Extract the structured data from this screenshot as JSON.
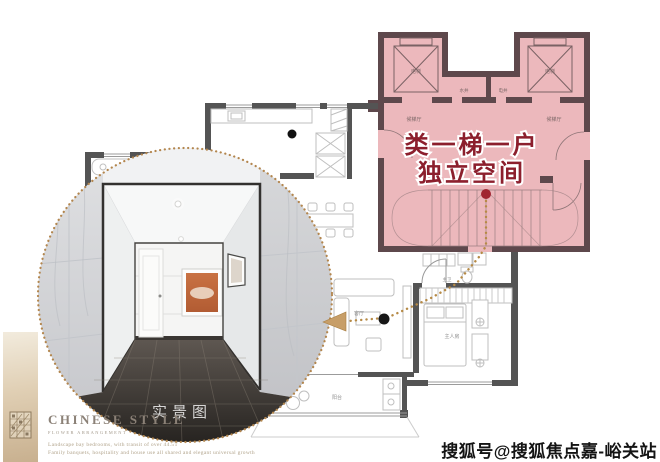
{
  "core": {
    "overlay_line1": "类一梯一户",
    "overlay_line2": "独立空间",
    "elevator_label": "电梯",
    "shaft_water_label": "水井",
    "shaft_elec_label": "电井",
    "lobby_label": "候梯厅"
  },
  "rooms": {
    "living_label": "客厅",
    "bedroom_label": "主人房",
    "bath_label": "主卫",
    "balcony_label": "阳台"
  },
  "photo": {
    "caption": "实景图"
  },
  "brand": {
    "title": "CHINESE STYLE",
    "subtitle": "FLOWER ARRANGEMENT",
    "desc_line1": "Landscape bay bedrooms, with transit of over 44.5T",
    "desc_line2": "Family banquets, hospitality and house use all shared and elegant universal growth"
  },
  "watermark": "搜狐号@搜狐焦点嘉-峪关站",
  "colors": {
    "core_fill": "#ecb8bc",
    "core_wall": "#5e484c",
    "unit_wall": "#545454",
    "accent_red": "#a12531",
    "overlay_text": "#8c1f2d",
    "path_gold": "#b68a46",
    "arrow_tan": "#c79e68"
  }
}
